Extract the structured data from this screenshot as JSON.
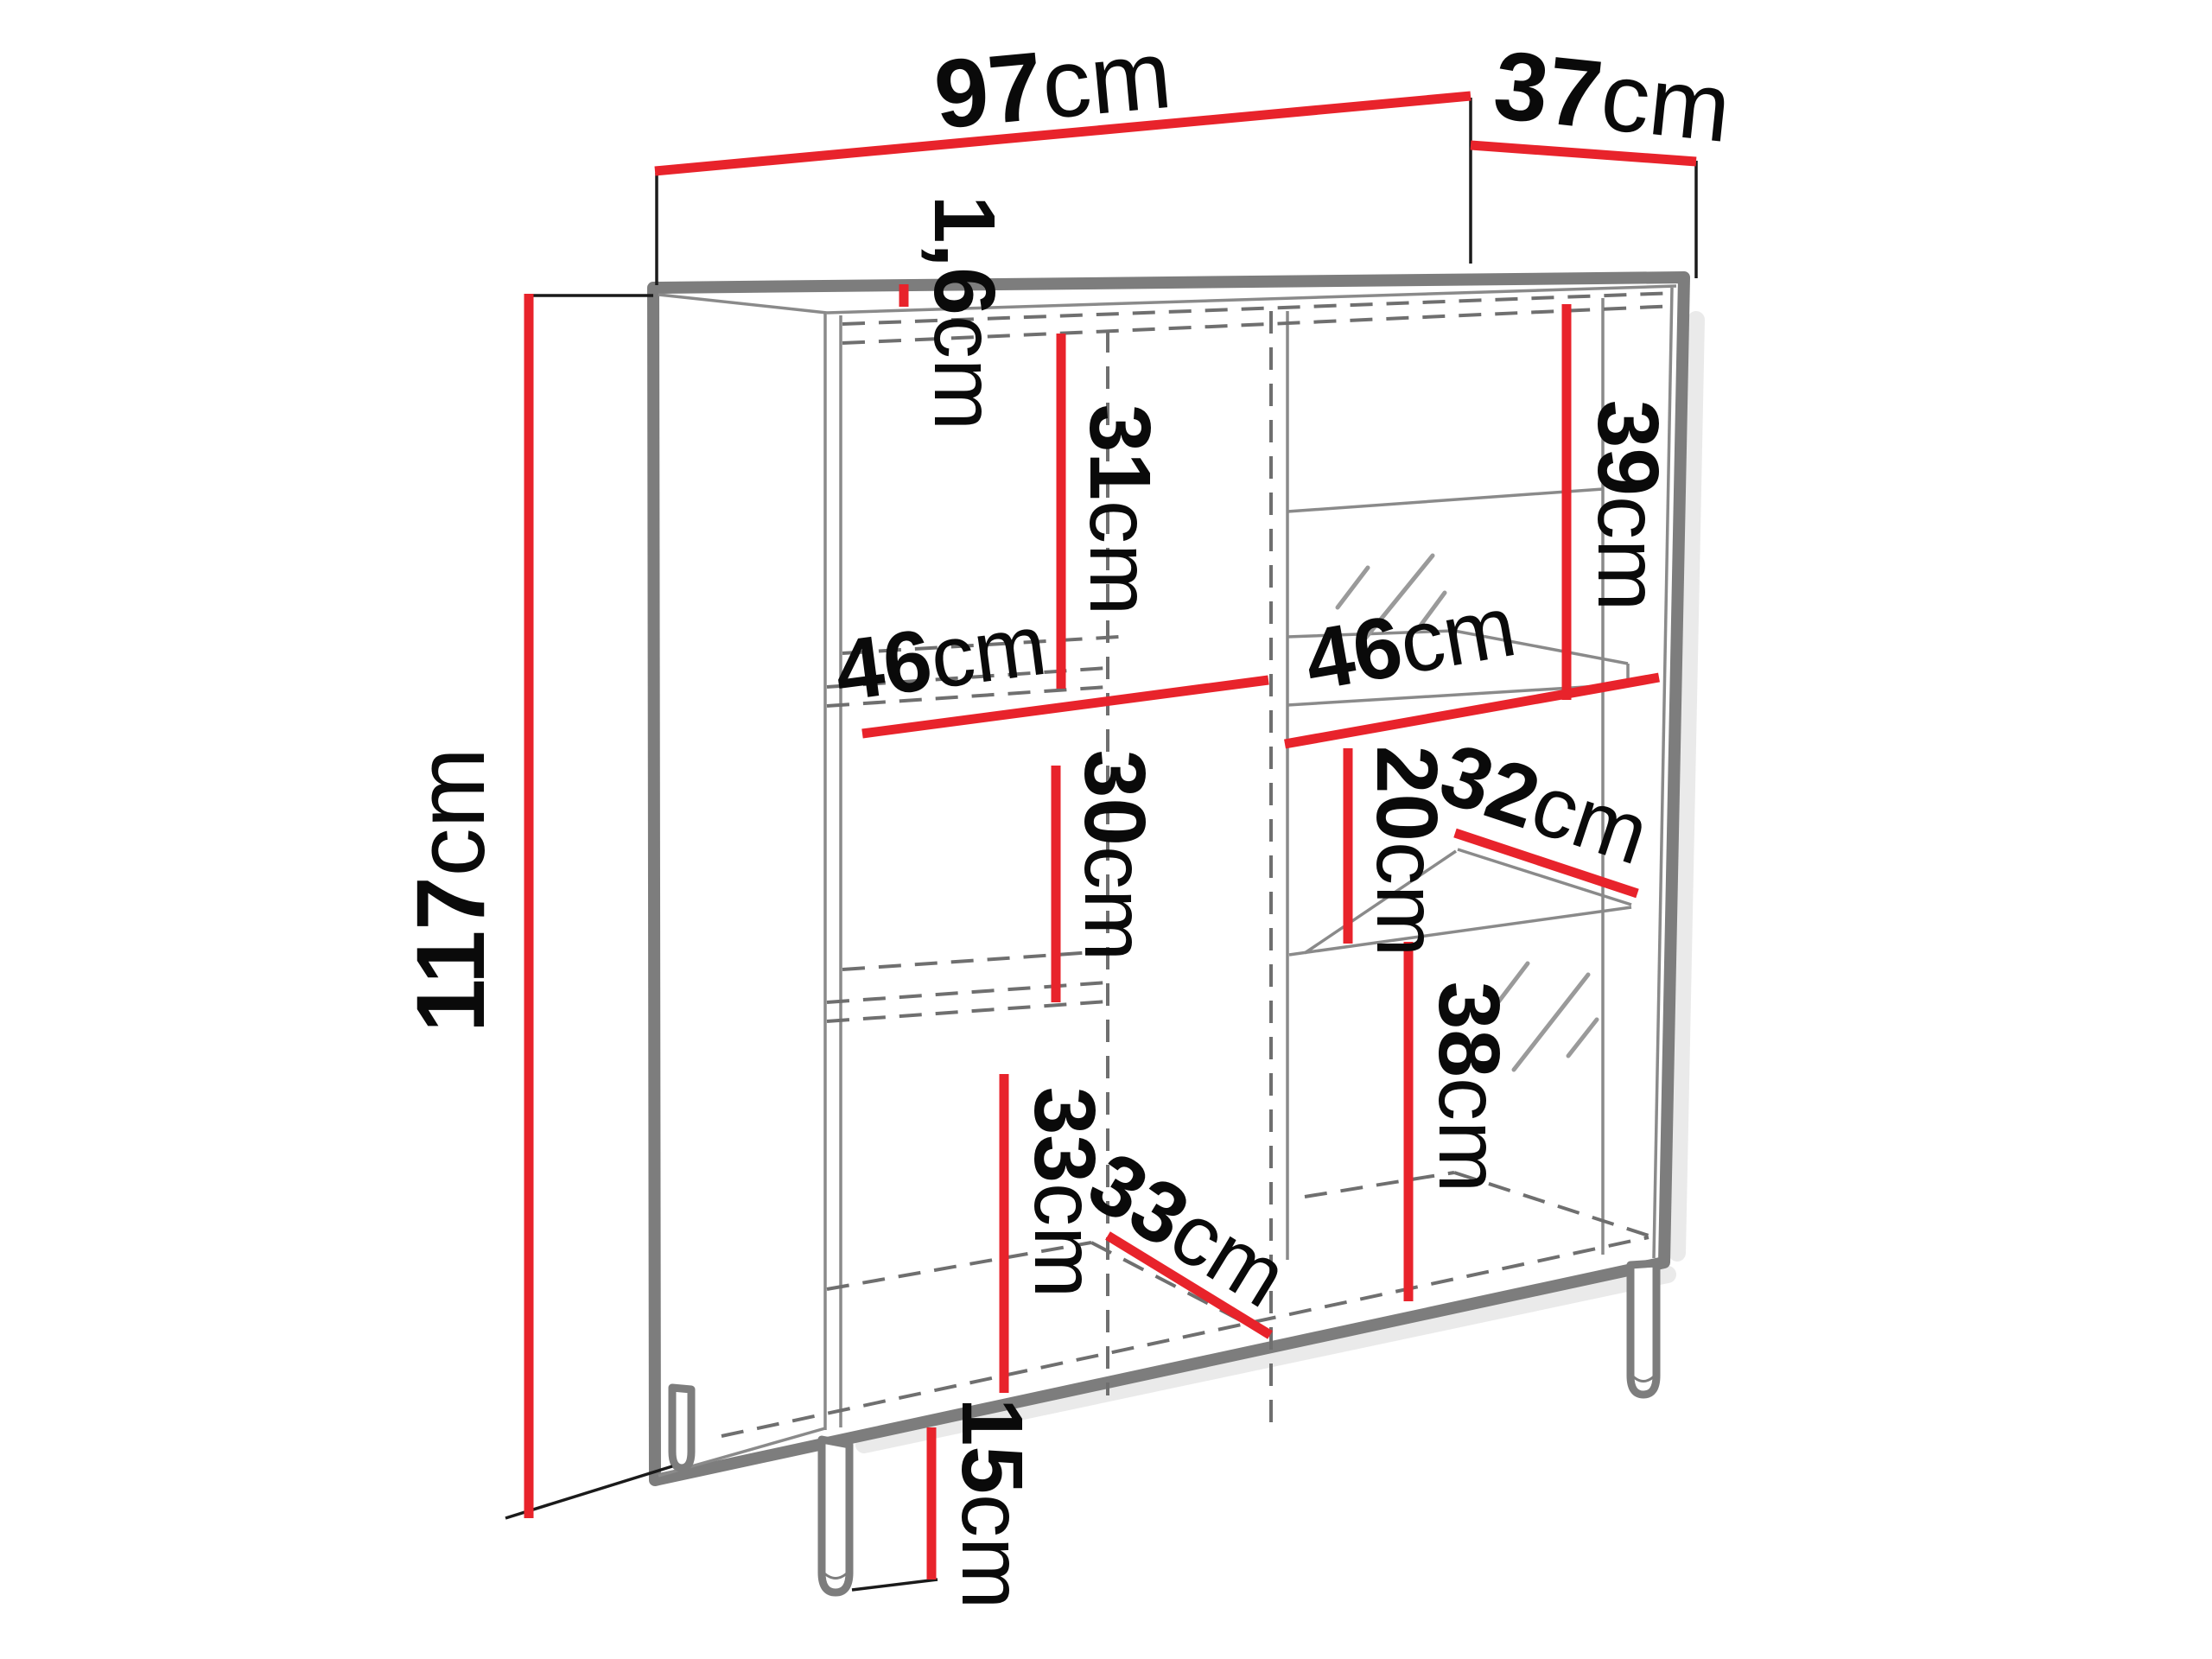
{
  "diagram": {
    "type": "furniture-dimension-drawing",
    "unit": "cm",
    "colors": {
      "dimension_line": "#e8232b",
      "cabinet_line": "#7d7d7d",
      "hidden_line": "#6f6f6f",
      "text": "#0a0a0a",
      "background": "#ffffff"
    },
    "labels": {
      "overall_width": {
        "num": "97",
        "unit": "cm"
      },
      "overall_depth": {
        "num": "37",
        "unit": "cm"
      },
      "overall_height": {
        "num": "117",
        "unit": "cm"
      },
      "top_thickness": {
        "num": "1,6",
        "unit": "cm"
      },
      "left_upper_height": {
        "num": "31",
        "unit": "cm"
      },
      "left_inner_width": {
        "num": "46",
        "unit": "cm"
      },
      "left_middle_height": {
        "num": "30",
        "unit": "cm"
      },
      "left_lower_height": {
        "num": "33",
        "unit": "cm"
      },
      "left_inner_depth": {
        "num": "33",
        "unit": "cm"
      },
      "right_upper_height": {
        "num": "39",
        "unit": "cm"
      },
      "right_inner_width": {
        "num": "46",
        "unit": "cm"
      },
      "right_middle_height": {
        "num": "20",
        "unit": "cm"
      },
      "right_shelf_depth": {
        "num": "32",
        "unit": "cm"
      },
      "right_lower_height": {
        "num": "38",
        "unit": "cm"
      },
      "leg_height": {
        "num": "15",
        "unit": "cm"
      }
    }
  }
}
